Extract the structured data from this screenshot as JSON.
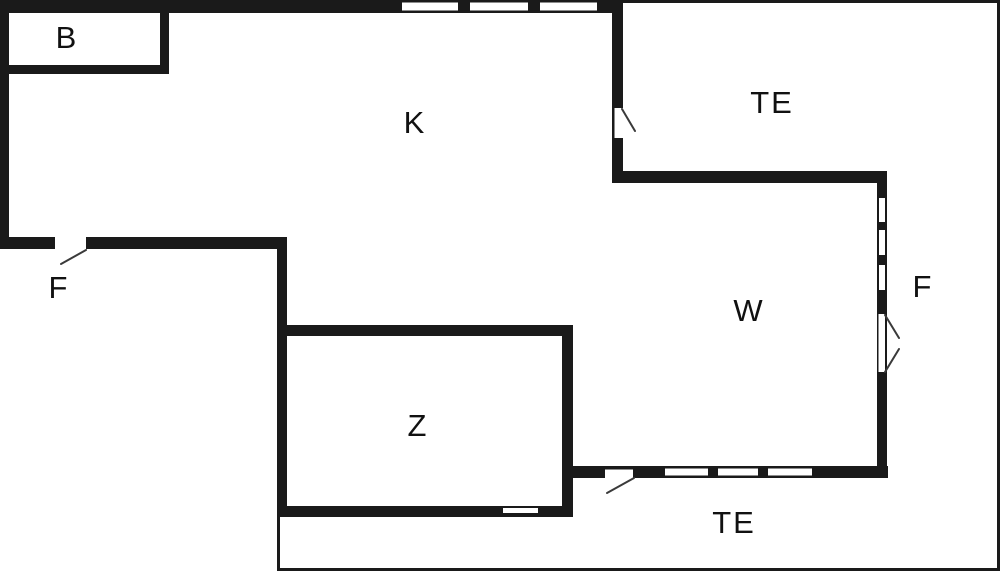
{
  "title": "floor-plan",
  "colors": {
    "wall": "#1a1a1a",
    "background": "#ffffff",
    "door_swing": "#3a3a3a",
    "label_text": "#111111"
  },
  "rooms": {
    "b": {
      "label": "B"
    },
    "k": {
      "label": "K"
    },
    "te_top": {
      "label": "TE"
    },
    "f_left": {
      "label": "F"
    },
    "w": {
      "label": "W"
    },
    "f_right": {
      "label": "F"
    },
    "z": {
      "label": "Z"
    },
    "te_bottom": {
      "label": "TE"
    }
  }
}
